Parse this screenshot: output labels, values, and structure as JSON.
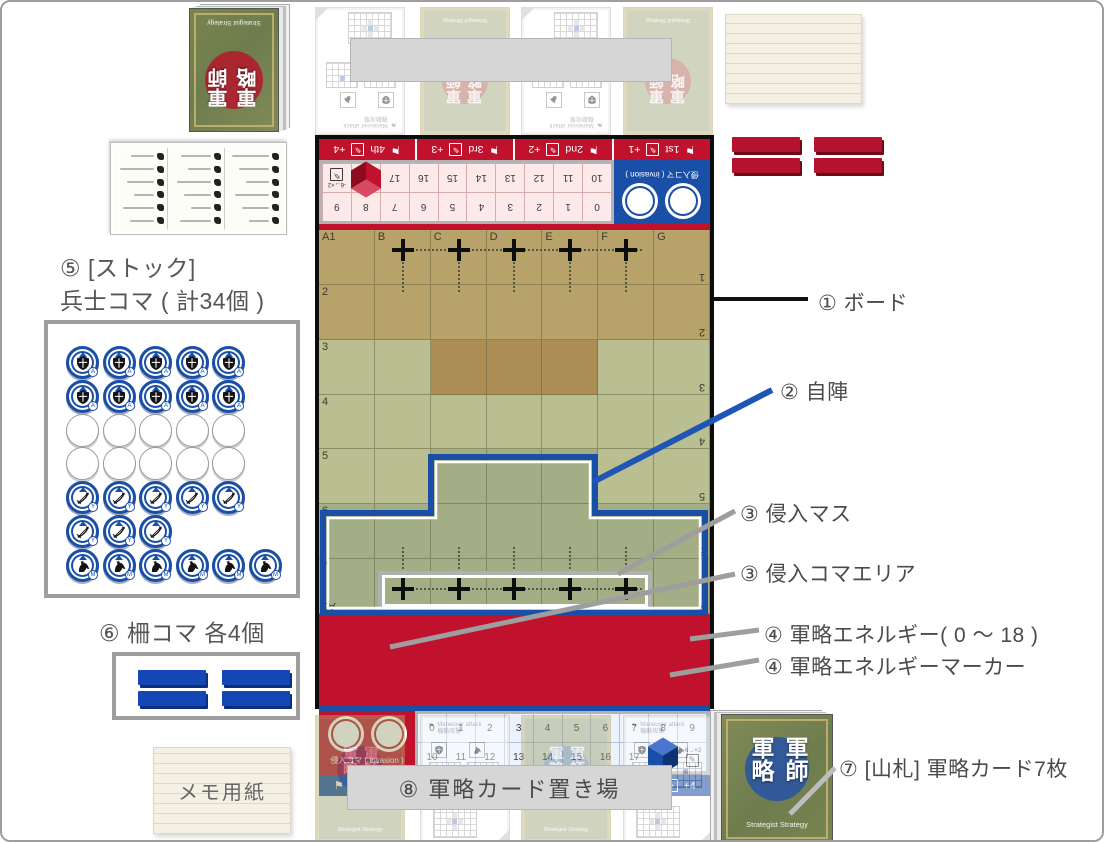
{
  "labels": {
    "board": "① ボード",
    "own_territory": "② 自陣",
    "invasion_squares": "③ 侵入マス",
    "invasion_piece_area": "③ 侵入コマエリア",
    "energy": "④ 軍略エネルギー( 0 〜 18 )",
    "energy_marker": "④ 軍略エネルギーマーカー",
    "stock_line1": "⑤ [ストック]",
    "stock_line2": "兵士コマ ( 計34個 )",
    "fence": "⑥ 柵コマ 各4個",
    "deck": "⑦ [山札] 軍略カード7枚",
    "card_area": "⑧ 軍略カード置き場",
    "memo": "メモ用紙",
    "top_banner": ""
  },
  "board": {
    "grid": {
      "col_labels": [
        "A1",
        "B",
        "C",
        "D",
        "E",
        "F",
        "G"
      ],
      "row_labels": [
        "2",
        "3",
        "4",
        "5",
        "6",
        "7"
      ],
      "mirrored_row_labels": [
        "1",
        "2",
        "3",
        "4",
        "5",
        "6",
        "7"
      ],
      "mirrored_corner_label": "A1"
    },
    "energy_track": {
      "row1": [
        "0",
        "1",
        "2",
        "3",
        "4",
        "5",
        "6",
        "7",
        "8",
        "9"
      ],
      "row2": [
        "10",
        "11",
        "12",
        "13",
        "14",
        "15",
        "16",
        "17"
      ],
      "marker_value": "18",
      "icon_cell_text": "-6→×2"
    },
    "invasion_box_label": "侵入コマ ( invasion )",
    "turns": [
      {
        "flag": "1st",
        "bonus": "+1"
      },
      {
        "flag": "2nd",
        "bonus": "+2"
      },
      {
        "flag": "3rd",
        "bonus": "+3"
      },
      {
        "flag": "4th",
        "bonus": "+4"
      }
    ],
    "colors": {
      "red": "#c0122d",
      "blue": "#1a4fa8",
      "tan": "#b7a269",
      "tan_dark": "#ac8e55",
      "green_light": "#b9bf90",
      "green_dark": "#a3ae86",
      "cube_red": [
        "#d84a63",
        "#c0122d",
        "#8c0c1f"
      ],
      "cube_blue": [
        "#4a76cf",
        "#1a4fa8",
        "#0e3374"
      ]
    }
  },
  "stock": {
    "rows": [
      {
        "type": "shield",
        "count": 5
      },
      {
        "type": "shield",
        "count": 5
      },
      {
        "type": "blank",
        "count": 5
      },
      {
        "type": "blank",
        "count": 5
      },
      {
        "type": "bow",
        "count": 5
      },
      {
        "type": "bow",
        "count": 3
      },
      {
        "type": "horse",
        "count": 6
      }
    ],
    "badges": {
      "shield": "A",
      "bow": "Y",
      "horse": "M"
    }
  },
  "fences": {
    "blue_count": 4,
    "red_count": 4
  },
  "decks": {
    "back_chars": "軍師軍略",
    "subtitle": "Strategist Strategy"
  },
  "ghost_card": {
    "header_en": "Maneuver attack",
    "header_jp": "機動攻撃"
  }
}
